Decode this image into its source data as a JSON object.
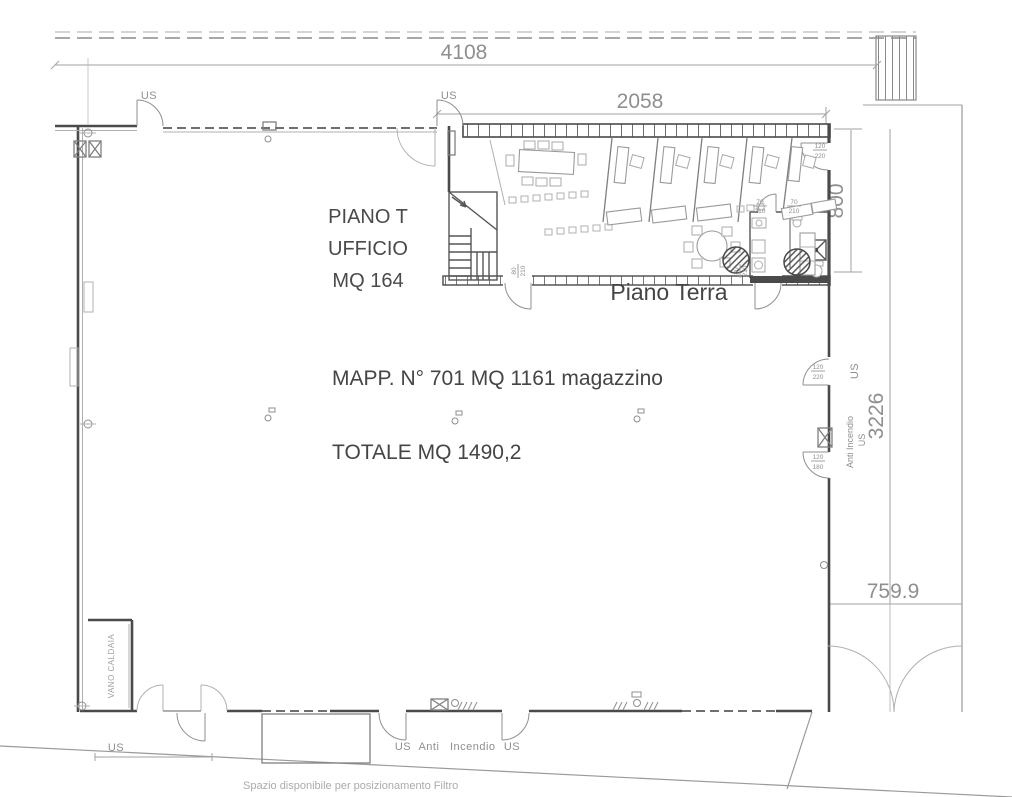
{
  "plan": {
    "floor_title": "Piano Terra",
    "zone_label": {
      "l1": "PIANO T",
      "l2": "UFFICIO",
      "l3": "MQ 164"
    },
    "mapp_label": "MAPP. N° 701 MQ 1161 magazzino",
    "total_label": "TOTALE MQ 1490,2",
    "filter_note": "Spazio disponibile per posizionamento Filtro",
    "boiler_room": "VANO CALDAIA",
    "exit": "US",
    "fire_label": "Anti Incendio",
    "dims": {
      "site_width": "4108",
      "office_width": "2058",
      "office_depth": "800",
      "side_height": "3226",
      "gate_width": "759.9"
    },
    "sizes": {
      "n120": "120",
      "n220": "220",
      "n180": "180",
      "n80": "80",
      "n70": "70",
      "n210": "210"
    }
  },
  "colors": {
    "walls": "#4a4a4a",
    "dims": "#9b9b9b",
    "text_dark": "#454545",
    "text_dim": "#8f8f8f",
    "furniture": "#9a9a9a",
    "background": "#ffffff"
  }
}
